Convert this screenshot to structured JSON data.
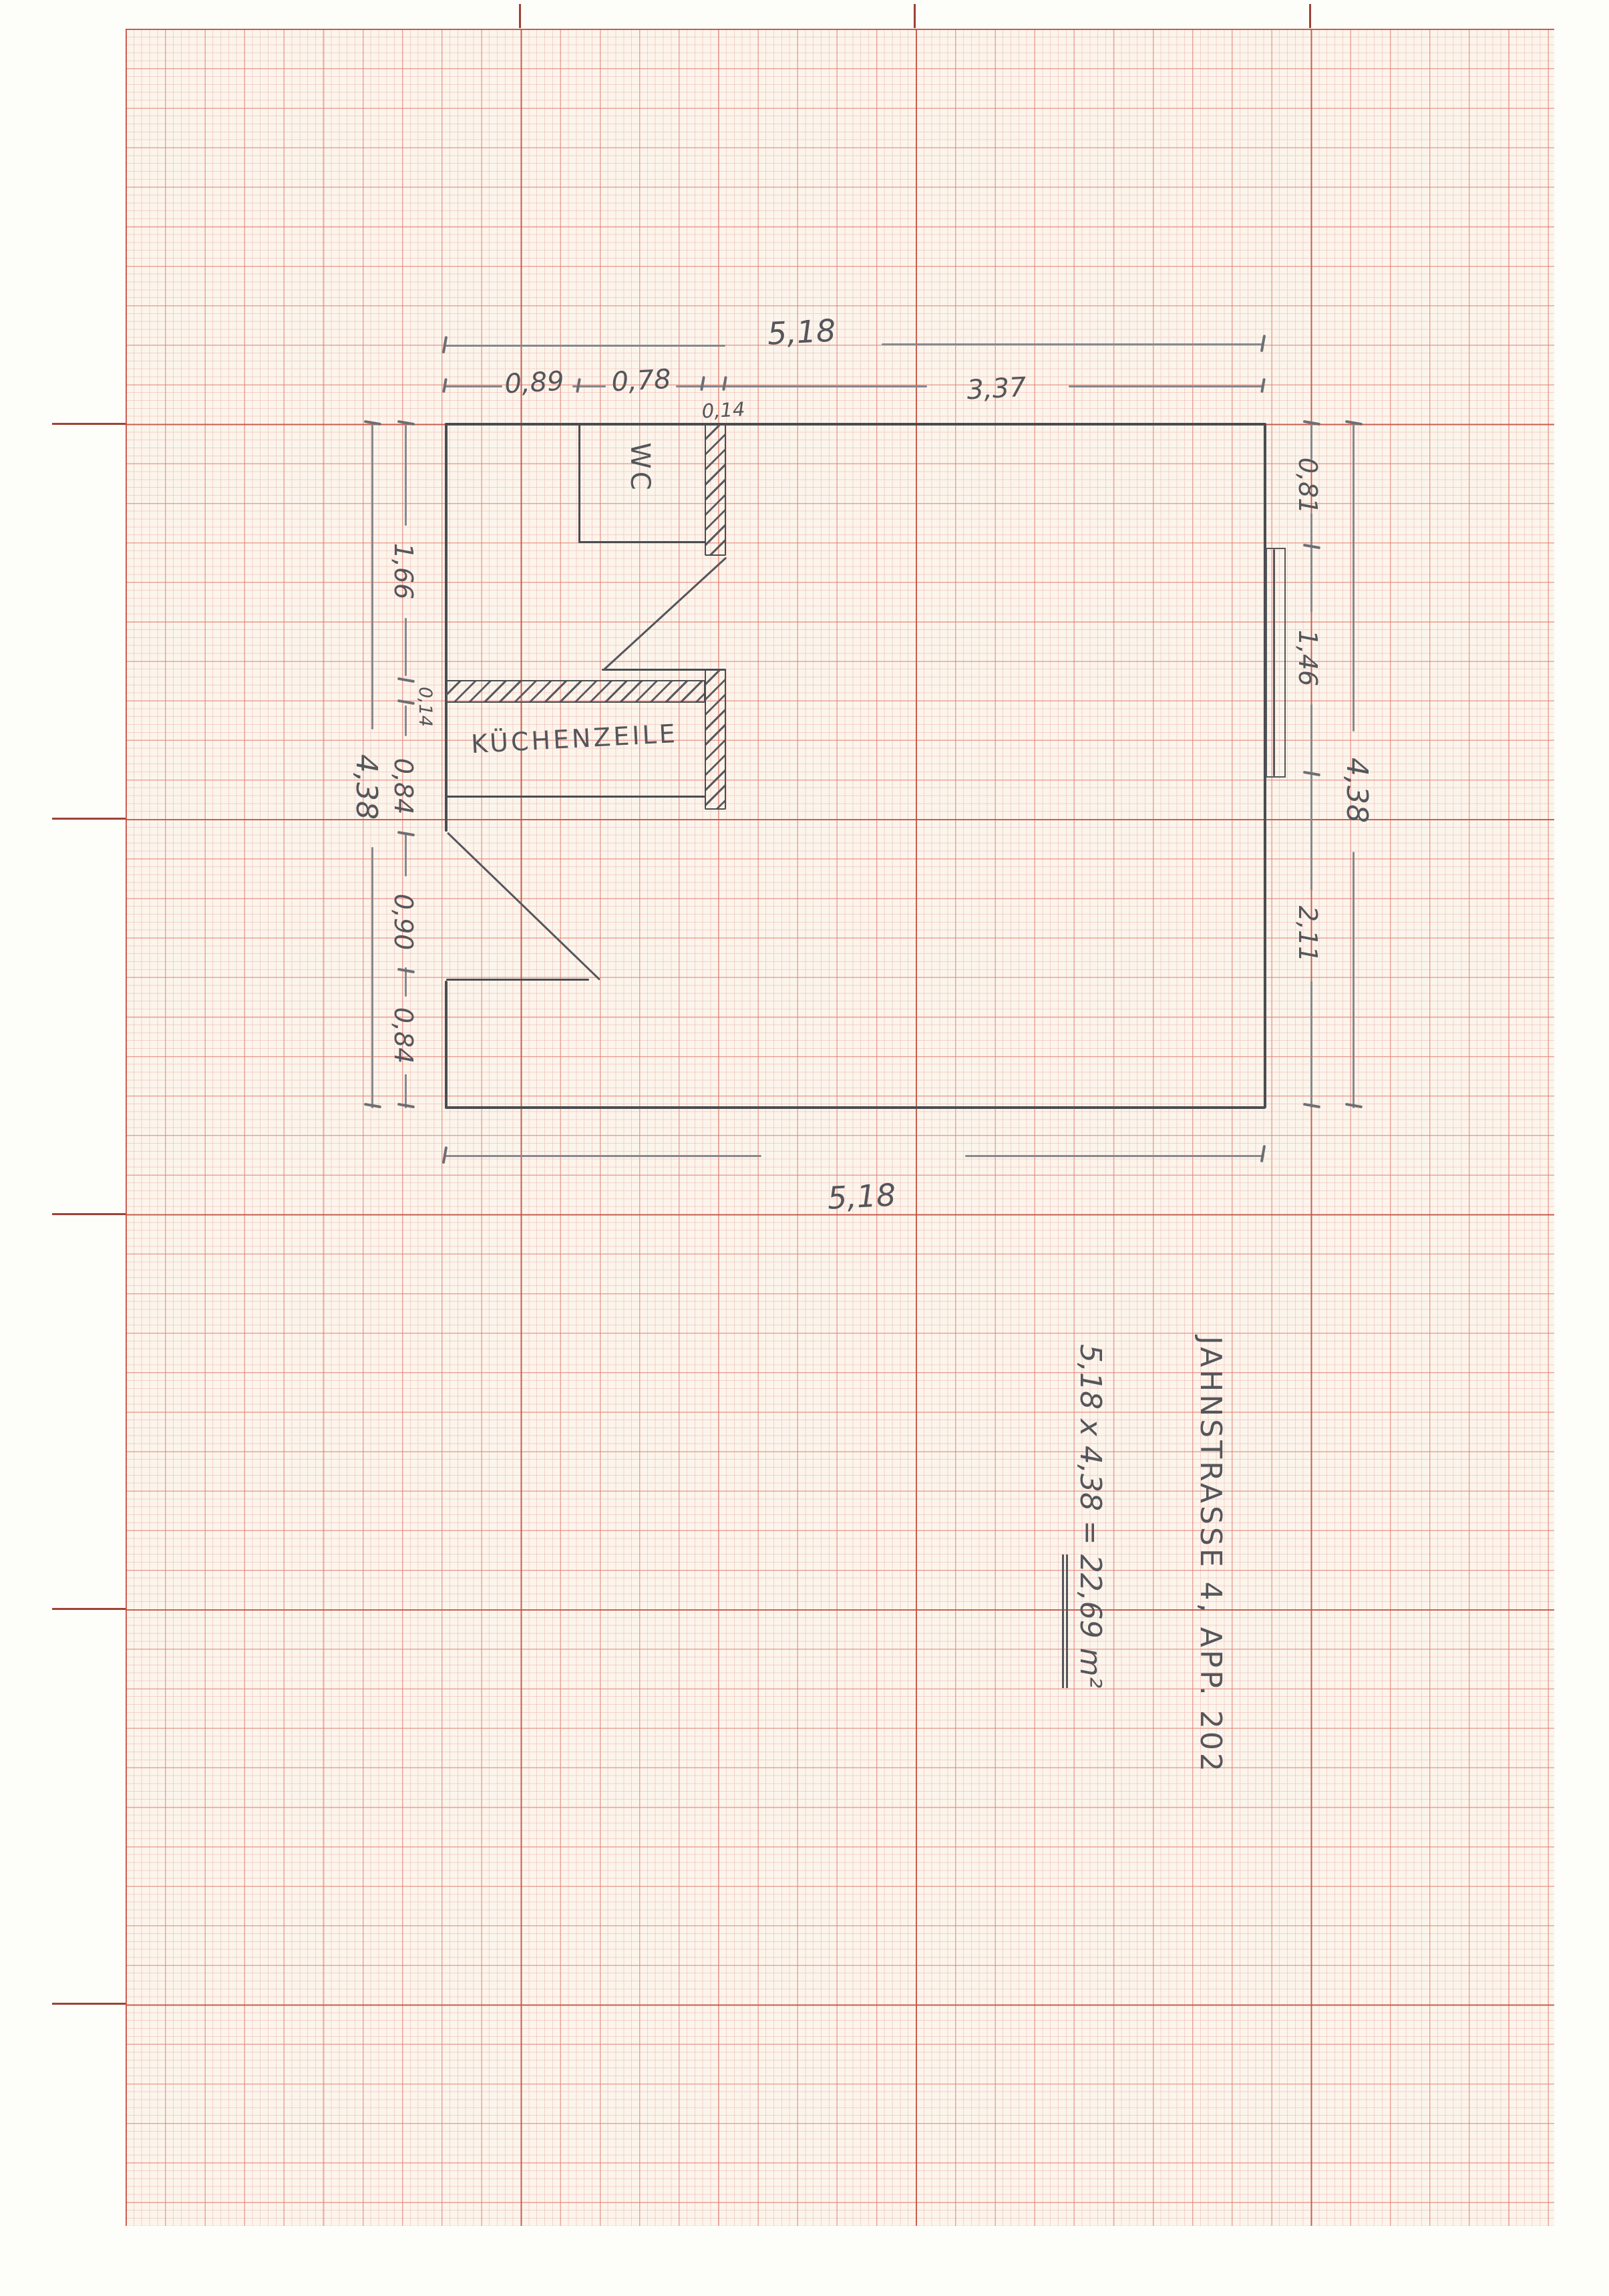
{
  "annotation": {
    "address": "JAHNSTRASSE 4, APP. 202",
    "equation": "5,18 x 4,38 =",
    "result": "22,69 m²"
  },
  "rooms": {
    "wc": "WC",
    "kitchen": "KÜCHENZEILE"
  },
  "dimensions": {
    "top": {
      "total": "5,18",
      "segments": [
        "0,89",
        "0,78",
        "0,14",
        "3,37"
      ]
    },
    "bottom": {
      "total": "5,18"
    },
    "left": {
      "total": "4,38",
      "segments": [
        "1,66",
        "0,14",
        "0,84",
        "0,90",
        "0,84"
      ]
    },
    "right": {
      "total": "4,38",
      "segments": [
        "0,81",
        "1,46",
        "2,11"
      ]
    }
  },
  "colors": {
    "pencil_wall": "#4b4c50",
    "pencil_dimension": "#87888d",
    "pencil_text": "#55565b",
    "grid_fine": "#f0b4ac",
    "grid_medium": "#e2766a",
    "grid_major": "#c44d3f",
    "paper": "#fbf5ec"
  }
}
